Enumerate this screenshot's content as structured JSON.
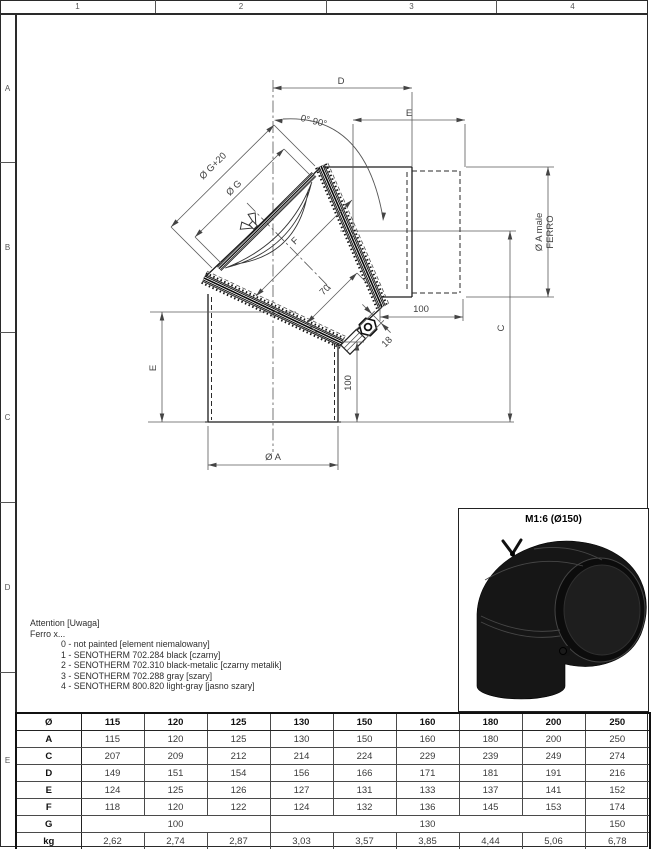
{
  "sheet": {
    "top_ruler": [
      "1",
      "2",
      "3",
      "4"
    ],
    "left_ruler": [
      "A",
      "B",
      "C",
      "D",
      "E"
    ]
  },
  "drawing": {
    "labels": {
      "d": "D",
      "e_top": "E",
      "angle": "0°-90°",
      "g20": "Ø G+20",
      "g": "Ø G",
      "f": "F",
      "len70": "70",
      "len100_h": "100",
      "len18": "18",
      "len100_v": "100",
      "e_left": "E",
      "dia_a": "Ø A",
      "c": "C",
      "male_1": "Ø A male",
      "male_2": "FERRO"
    }
  },
  "preview": {
    "scale_label": "M1:6 (Ø150)"
  },
  "notes": {
    "lines": [
      "Attention [Uwaga]",
      "Ferro x...",
      "0 - not painted [element niemalowany]",
      "1 - SENOTHERM 702.284 black [czarny]",
      "2 - SENOTHERM 702.310 black-metalic [czarny metalik]",
      "3 - SENOTHERM 702.288 gray [szary]",
      "4 - SENOTHERM 800.820 light-gray [jasno szary]"
    ]
  },
  "table": {
    "header": [
      "Ø",
      "115",
      "120",
      "125",
      "130",
      "150",
      "160",
      "180",
      "200",
      "250"
    ],
    "rows": [
      [
        "A",
        "115",
        "120",
        "125",
        "130",
        "150",
        "160",
        "180",
        "200",
        "250"
      ],
      [
        "C",
        "207",
        "209",
        "212",
        "214",
        "224",
        "229",
        "239",
        "249",
        "274"
      ],
      [
        "D",
        "149",
        "151",
        "154",
        "156",
        "166",
        "171",
        "181",
        "191",
        "216"
      ],
      [
        "E",
        "124",
        "125",
        "126",
        "127",
        "131",
        "133",
        "137",
        "141",
        "152"
      ],
      [
        "F",
        "118",
        "120",
        "122",
        "124",
        "132",
        "136",
        "145",
        "153",
        "174"
      ]
    ],
    "g_row": {
      "label": "G",
      "cells": [
        {
          "value": "100",
          "span": 3
        },
        {
          "value": "130",
          "span": 5
        },
        {
          "value": "150",
          "span": 1
        }
      ]
    },
    "kg_row": [
      "kg",
      "2,62",
      "2,74",
      "2,87",
      "3,03",
      "3,57",
      "3,85",
      "4,44",
      "5,06",
      "6,78"
    ]
  }
}
